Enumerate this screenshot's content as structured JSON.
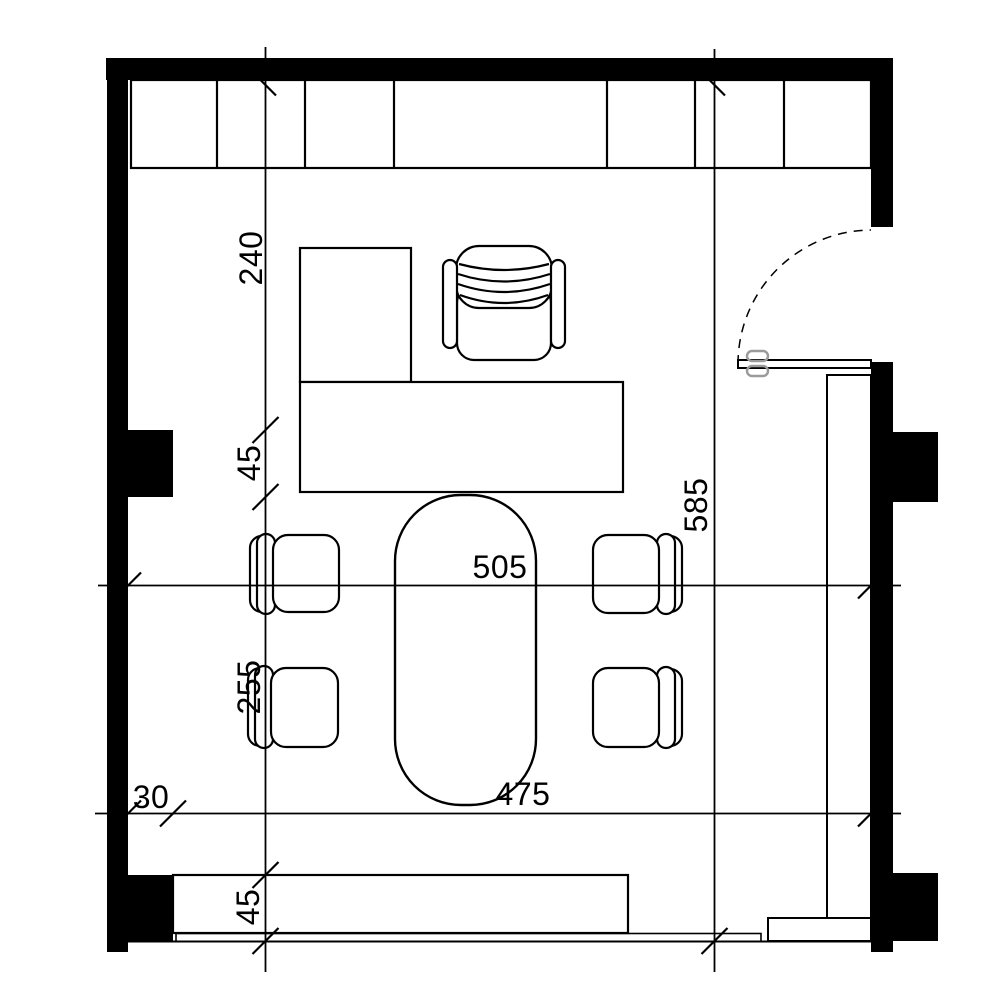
{
  "drawing": {
    "type": "architectural-floor-plan",
    "room": "office with desk, meeting table and built-in cabinets"
  },
  "colors": {
    "line": "#000000",
    "wall_fill": "#000000",
    "background": "#ffffff",
    "door_handle": "#9a9a9a"
  },
  "dimensions": {
    "desk_zone_depth": "240",
    "pier_upper_width": "45",
    "meeting_zone_depth": "255",
    "window_cabinet_depth": "45",
    "pier_depth": "30",
    "room_width": "505",
    "clear_width": "475",
    "room_depth": "585"
  }
}
